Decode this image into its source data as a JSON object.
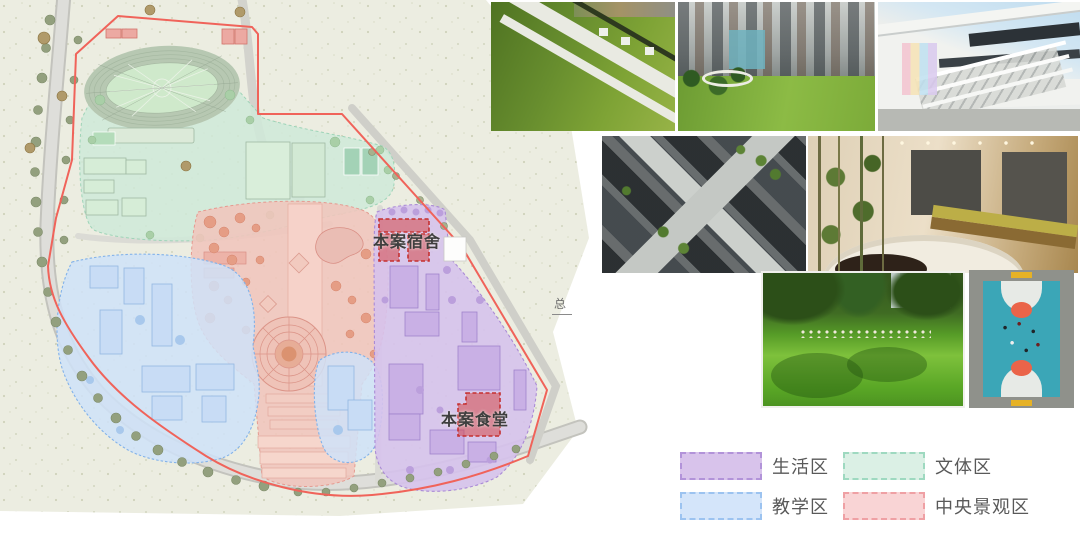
{
  "site_plan": {
    "annotations": {
      "dormitory": "本案宿舍",
      "canteen": "本案食堂",
      "corner_note": "总"
    },
    "boundary_color": "#f0635a",
    "highlight_color": "#c53030",
    "zone_colors": {
      "living": "#d6c2ec",
      "teaching": "#cfe2f8",
      "sports": "#cfe9d8",
      "central_landscape": "#f0c5bc"
    }
  },
  "legend": {
    "items": [
      {
        "label": "生活区",
        "fill": "#d8c3eb",
        "border": "#b293d9"
      },
      {
        "label": "文体区",
        "fill": "#dbf0e5",
        "border": "#9ed9c0"
      },
      {
        "label": "教学区",
        "fill": "#d4e5fa",
        "border": "#9cc3f0"
      },
      {
        "label": "中央景观区",
        "fill": "#f9d4d5",
        "border": "#efa0a4"
      }
    ]
  },
  "photos": [
    {
      "name": "green-roof-landscape-aerial"
    },
    {
      "name": "city-park-with-skyscrapers"
    },
    {
      "name": "school-building-colorful-stair"
    },
    {
      "name": "campus-courtyard-aerial"
    },
    {
      "name": "interior-commons-with-bamboo"
    },
    {
      "name": "park-lawn-gathering"
    },
    {
      "name": "basketball-court-aerial"
    }
  ]
}
